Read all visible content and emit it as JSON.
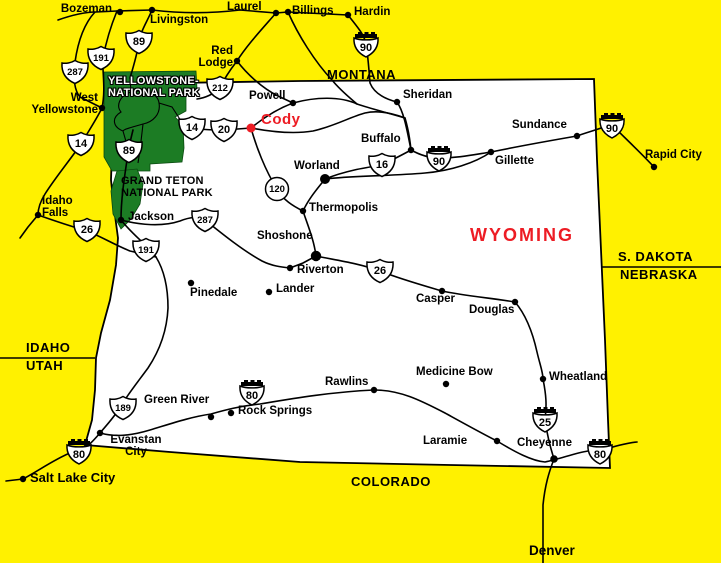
{
  "map_title": "Wyoming highway map",
  "colors": {
    "background": "#FFF100",
    "park_green": "#1C7C24",
    "highlight_red": "#ED1C24",
    "road_black": "#000000",
    "wyoming_fill": "#FFFFFF"
  },
  "states": [
    {
      "name": "MONTANA",
      "x": 327,
      "y": 68,
      "size": 13
    },
    {
      "name": "WYOMING",
      "x": 470,
      "y": 226,
      "size": 18,
      "color": "red",
      "ls": 2
    },
    {
      "name": "S. DAKOTA",
      "x": 618,
      "y": 250,
      "size": 13
    },
    {
      "name": "NEBRASKA",
      "x": 620,
      "y": 268,
      "size": 13
    },
    {
      "name": "IDAHO",
      "x": 26,
      "y": 341,
      "size": 13
    },
    {
      "name": "UTAH",
      "x": 26,
      "y": 359,
      "size": 13
    },
    {
      "name": "COLORADO",
      "x": 351,
      "y": 475,
      "size": 13
    }
  ],
  "parks": [
    {
      "id": "yellowstone",
      "lines": [
        "YELLOWSTONE-",
        "NATIONAL PARK"
      ],
      "x": 108,
      "y": 76,
      "style": "outline"
    },
    {
      "id": "grand-teton",
      "lines": [
        "GRAND TETON",
        "NATIONAL PARK"
      ],
      "x": 121,
      "y": 176,
      "style": "plain"
    }
  ],
  "cities": [
    {
      "name": "Bozeman",
      "dot": {
        "x": 120,
        "y": 12,
        "r": 3.2
      },
      "label": {
        "x": 30,
        "y": 3,
        "w": 82,
        "align": "right"
      }
    },
    {
      "name": "Livingston",
      "dot": {
        "x": 152,
        "y": 10,
        "r": 3.2
      },
      "label": {
        "x": 150,
        "y": 14
      }
    },
    {
      "name": "Laurel",
      "dot": {
        "x": 276,
        "y": 13,
        "r": 3.2
      },
      "label": {
        "x": 227,
        "y": 1
      }
    },
    {
      "name": "Billings",
      "dot": {
        "x": 288,
        "y": 12,
        "r": 3.2
      },
      "label": {
        "x": 292,
        "y": 5
      }
    },
    {
      "name": "Hardin",
      "dot": {
        "x": 348,
        "y": 15,
        "r": 3.2
      },
      "label": {
        "x": 354,
        "y": 6
      }
    },
    {
      "name": "Red\nLodge",
      "dot": {
        "x": 237,
        "y": 61,
        "r": 3.2
      },
      "label": {
        "x": 188,
        "y": 45,
        "w": 45,
        "align": "right"
      }
    },
    {
      "name": "Powell",
      "dot": {
        "x": 293,
        "y": 103,
        "r": 3.2
      },
      "label": {
        "x": 249,
        "y": 90
      }
    },
    {
      "name": "Cody",
      "dot": {
        "x": 251,
        "y": 128,
        "r": 4.5,
        "color": "red"
      },
      "label": {
        "x": 261,
        "y": 112,
        "size": 15,
        "color": "red",
        "ls": 0.5
      }
    },
    {
      "name": "Sheridan",
      "dot": {
        "x": 397,
        "y": 102,
        "r": 3.2
      },
      "label": {
        "x": 403,
        "y": 89
      }
    },
    {
      "name": "Buffalo",
      "dot": {
        "x": 411,
        "y": 150,
        "r": 3.2
      },
      "label": {
        "x": 361,
        "y": 133
      }
    },
    {
      "name": "Gillette",
      "dot": {
        "x": 491,
        "y": 152,
        "r": 3.2
      },
      "label": {
        "x": 495,
        "y": 155
      }
    },
    {
      "name": "Sundance",
      "dot": {
        "x": 577,
        "y": 136,
        "r": 3.2
      },
      "label": {
        "x": 512,
        "y": 119
      }
    },
    {
      "name": "Rapid City",
      "dot": {
        "x": 654,
        "y": 167,
        "r": 3.2
      },
      "label": {
        "x": 645,
        "y": 149
      }
    },
    {
      "name": "Worland",
      "dot": {
        "x": 325,
        "y": 179,
        "r": 5
      },
      "label": {
        "x": 294,
        "y": 160
      }
    },
    {
      "name": "Thermopolis",
      "dot": {
        "x": 303,
        "y": 211,
        "r": 3.2
      },
      "label": {
        "x": 309,
        "y": 202
      }
    },
    {
      "name": "Shoshone",
      "dot": {
        "x": 316,
        "y": 256,
        "r": 5.2
      },
      "label": {
        "x": 257,
        "y": 230
      }
    },
    {
      "name": "Riverton",
      "dot": {
        "x": 290,
        "y": 268,
        "r": 3.2
      },
      "label": {
        "x": 297,
        "y": 264
      }
    },
    {
      "name": "Lander",
      "dot": {
        "x": 269,
        "y": 292,
        "r": 3.2
      },
      "label": {
        "x": 276,
        "y": 283
      }
    },
    {
      "name": "Pinedale",
      "dot": {
        "x": 191,
        "y": 283,
        "r": 3.2
      },
      "label": {
        "x": 190,
        "y": 287
      }
    },
    {
      "name": "Jackson",
      "dot": {
        "x": 121,
        "y": 220,
        "r": 3.2
      },
      "label": {
        "x": 128,
        "y": 211
      }
    },
    {
      "name": "Idaho\nFalls",
      "dot": {
        "x": 38,
        "y": 215,
        "r": 3.2
      },
      "label": {
        "x": 42,
        "y": 195
      }
    },
    {
      "name": "West\nYellowstone",
      "dot": {
        "x": 102,
        "y": 108,
        "r": 3.2
      },
      "label": {
        "x": 16,
        "y": 92,
        "w": 82,
        "align": "right"
      }
    },
    {
      "name": "Casper",
      "dot": {
        "x": 442,
        "y": 291,
        "r": 3.2
      },
      "label": {
        "x": 416,
        "y": 293
      }
    },
    {
      "name": "Douglas",
      "dot": {
        "x": 515,
        "y": 302,
        "r": 3.2
      },
      "label": {
        "x": 469,
        "y": 304
      }
    },
    {
      "name": "Medicine Bow",
      "dot": {
        "x": 446,
        "y": 384,
        "r": 3.2
      },
      "label": {
        "x": 416,
        "y": 366
      }
    },
    {
      "name": "Wheatland",
      "dot": {
        "x": 543,
        "y": 379,
        "r": 3.2
      },
      "label": {
        "x": 549,
        "y": 371
      }
    },
    {
      "name": "Rawlins",
      "dot": {
        "x": 374,
        "y": 390,
        "r": 3.2
      },
      "label": {
        "x": 325,
        "y": 376
      }
    },
    {
      "name": "Green River",
      "dot": {
        "x": 211,
        "y": 417,
        "r": 3.2
      },
      "label": {
        "x": 144,
        "y": 394
      }
    },
    {
      "name": "Rock Springs",
      "dot": {
        "x": 231,
        "y": 413,
        "r": 3.2
      },
      "label": {
        "x": 238,
        "y": 405
      }
    },
    {
      "name": "Evanstan\nCity",
      "dot": {
        "x": 100,
        "y": 433,
        "r": 3.2
      },
      "label": {
        "x": 104,
        "y": 434,
        "w": 64,
        "align": "center"
      }
    },
    {
      "name": "Salt Lake City",
      "dot": {
        "x": 23,
        "y": 479,
        "r": 3.2
      },
      "label": {
        "x": 30,
        "y": 471,
        "size": 13
      }
    },
    {
      "name": "Laramie",
      "dot": {
        "x": 497,
        "y": 441,
        "r": 3.2
      },
      "label": {
        "x": 423,
        "y": 435
      }
    },
    {
      "name": "Cheyenne",
      "dot": {
        "x": 554,
        "y": 459,
        "r": 3.8
      },
      "label": {
        "x": 517,
        "y": 437
      }
    },
    {
      "name": "Denver",
      "dot": null,
      "label": {
        "x": 529,
        "y": 544,
        "size": 13.5
      }
    }
  ],
  "shields": [
    {
      "type": "us",
      "num": "191",
      "x": 101,
      "y": 58
    },
    {
      "type": "us",
      "num": "89",
      "x": 139,
      "y": 42
    },
    {
      "type": "us",
      "num": "287",
      "x": 75,
      "y": 72
    },
    {
      "type": "us",
      "num": "212",
      "x": 220,
      "y": 88
    },
    {
      "type": "us",
      "num": "14",
      "x": 192,
      "y": 128
    },
    {
      "type": "us",
      "num": "20",
      "x": 224,
      "y": 130
    },
    {
      "type": "us",
      "num": "89",
      "x": 129,
      "y": 151
    },
    {
      "type": "us",
      "num": "14",
      "x": 81,
      "y": 144
    },
    {
      "type": "us",
      "num": "26",
      "x": 87,
      "y": 230
    },
    {
      "type": "us",
      "num": "16",
      "x": 382,
      "y": 165
    },
    {
      "type": "us",
      "num": "287",
      "x": 205,
      "y": 220
    },
    {
      "type": "us",
      "num": "191",
      "x": 146,
      "y": 250
    },
    {
      "type": "us",
      "num": "26",
      "x": 380,
      "y": 271
    },
    {
      "type": "us",
      "num": "189",
      "x": 123,
      "y": 408
    },
    {
      "type": "circle",
      "num": "120",
      "x": 277,
      "y": 189
    },
    {
      "type": "i",
      "num": "90",
      "x": 366,
      "y": 44
    },
    {
      "type": "i",
      "num": "90",
      "x": 439,
      "y": 158
    },
    {
      "type": "i",
      "num": "90",
      "x": 612,
      "y": 125
    },
    {
      "type": "i",
      "num": "80",
      "x": 79,
      "y": 451
    },
    {
      "type": "i",
      "num": "80",
      "x": 252,
      "y": 392
    },
    {
      "type": "i",
      "num": "80",
      "x": 600,
      "y": 451
    },
    {
      "type": "i",
      "num": "25",
      "x": 545,
      "y": 419
    }
  ]
}
